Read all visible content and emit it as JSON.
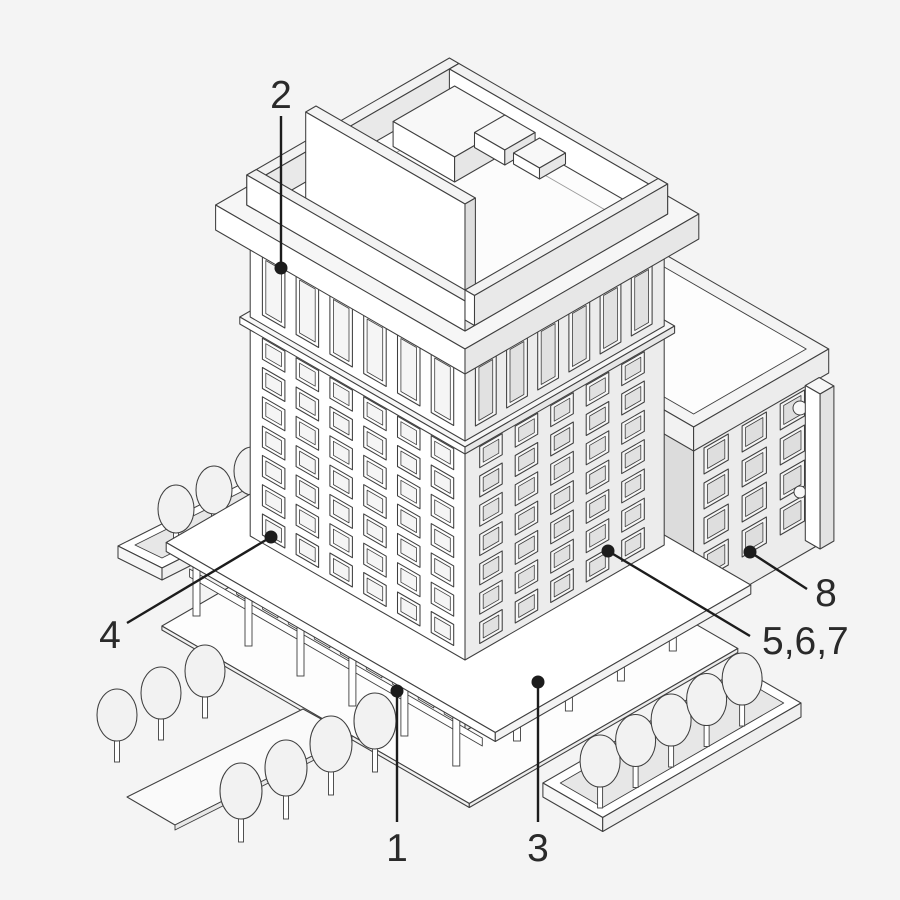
{
  "diagram": {
    "title": "Isometric office building diagram",
    "description": "Line-art isometric illustration of a modernist high-rise tower with rooftop structures, ground-level colonnade plaza, annex building, planters and trees, annotated with numbered callouts",
    "colors": {
      "background": "#f4f4f4",
      "ink": "#3f3f3f",
      "label_ink": "#2a2a2a",
      "callout_line": "#1c1c1c",
      "face_light": "#ffffff",
      "face_shade": "#ececec",
      "recess_shade": "#e1e1e1",
      "foliage": "#f2f2f2"
    },
    "callouts": [
      {
        "id": "1",
        "label": "1",
        "target": "plaza-colonnade-rail-left"
      },
      {
        "id": "2",
        "label": "2",
        "target": "top-floor-window"
      },
      {
        "id": "3",
        "label": "3",
        "target": "plaza-colonnade-rail-right"
      },
      {
        "id": "4",
        "label": "4",
        "target": "lower-facade-window"
      },
      {
        "id": "5-6-7",
        "label": "5,6,7",
        "target": "facade-window-right"
      },
      {
        "id": "8",
        "label": "8",
        "target": "annex-window"
      }
    ]
  }
}
